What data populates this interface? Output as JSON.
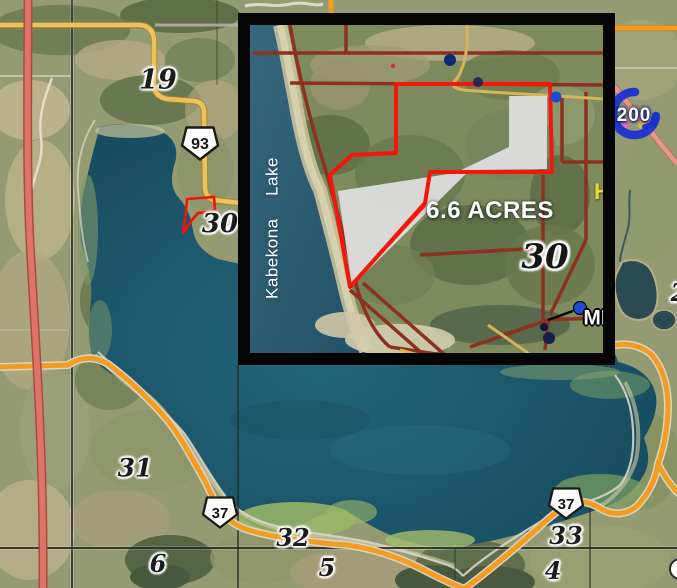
{
  "main_map": {
    "section_labels": [
      {
        "id": "19",
        "text": "19"
      },
      {
        "id": "30",
        "text": "30"
      },
      {
        "id": "31",
        "text": "31"
      },
      {
        "id": "32",
        "text": "32"
      },
      {
        "id": "33",
        "text": "33"
      },
      {
        "id": "6",
        "text": "6"
      },
      {
        "id": "5",
        "text": "5"
      },
      {
        "id": "4",
        "text": "4"
      },
      {
        "id": "2",
        "text": "2"
      }
    ],
    "highway_shields": [
      {
        "id": "93",
        "text": "93"
      },
      {
        "id": "37-west",
        "text": "37"
      },
      {
        "id": "37-east",
        "text": "37"
      }
    ],
    "route_marker": {
      "text": "200"
    }
  },
  "inset_map": {
    "lake_label": "Kabekona  Lake",
    "acreage_label": "6.6 ACRES",
    "section_label": "30",
    "partial_label_right": "MI",
    "partial_label_h": "H"
  },
  "colors": {
    "parcel_outline": "#f5150c",
    "parcel_fill": "#dcdcdc",
    "highway_orange": "#f39c1f",
    "highway_yellow": "#ecc25e",
    "highway_red": "#de7468",
    "inset_road_red": "#8c3120",
    "marker_blue": "#1c33cf",
    "lake_deep": "#1d5a6e"
  }
}
